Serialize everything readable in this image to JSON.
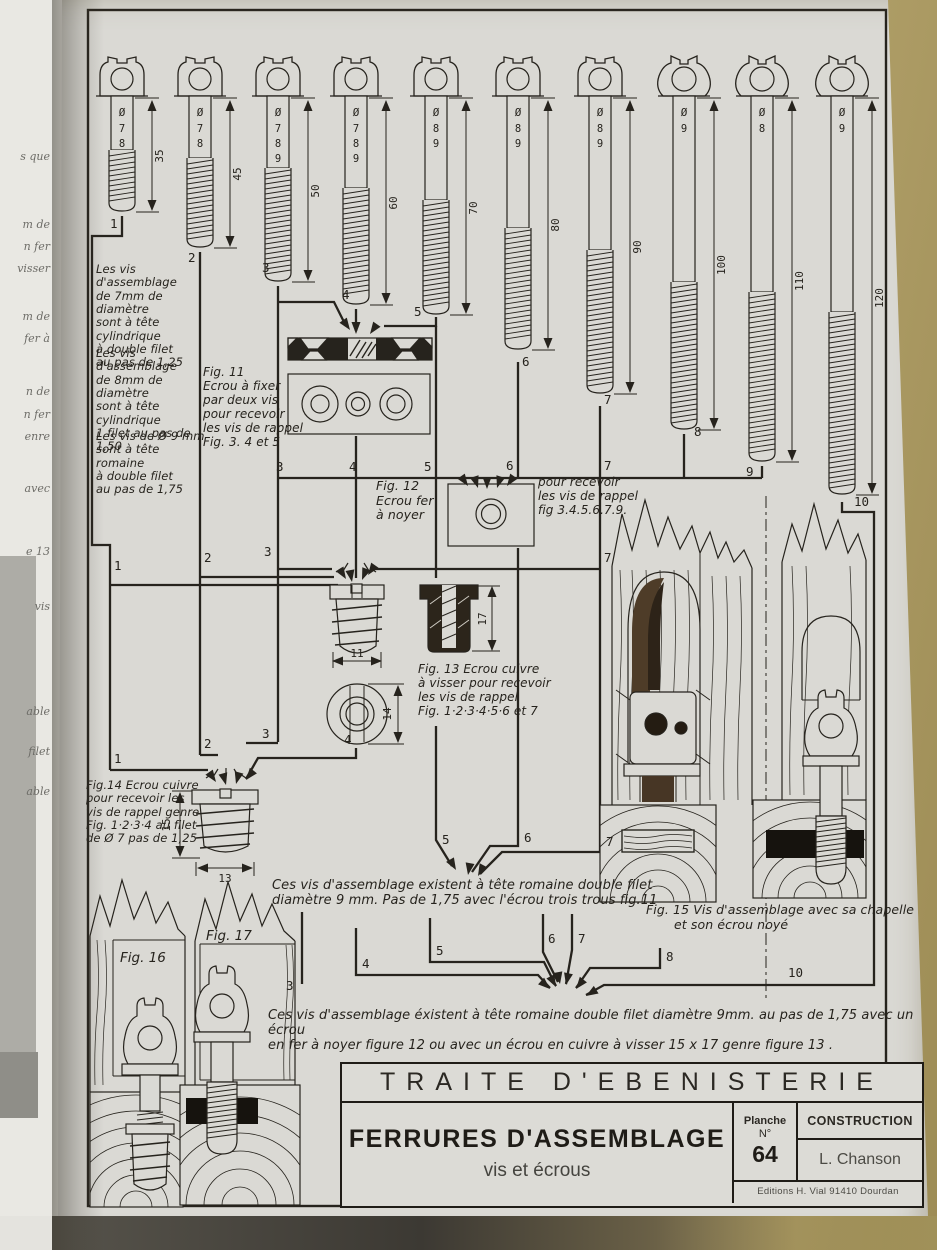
{
  "plate": {
    "screws": [
      {
        "number": "1",
        "diameters": [
          "7",
          "8"
        ],
        "length": "35"
      },
      {
        "number": "2",
        "diameters": [
          "7",
          "8"
        ],
        "length": "45"
      },
      {
        "number": "3",
        "diameters": [
          "7",
          "8",
          "9"
        ],
        "length": "50"
      },
      {
        "number": "4",
        "diameters": [
          "7",
          "8",
          "9"
        ],
        "length": "60"
      },
      {
        "number": "5",
        "diameters": [
          "8",
          "9"
        ],
        "length": "70"
      },
      {
        "number": "6",
        "diameters": [
          "8",
          "9"
        ],
        "length": "80"
      },
      {
        "number": "7",
        "diameters": [
          "8",
          "9"
        ],
        "length": "90"
      },
      {
        "number": "8",
        "diameters": [
          "9"
        ],
        "length": "100"
      },
      {
        "number": "9",
        "diameters": [
          "8"
        ],
        "length": "110"
      },
      {
        "number": "10",
        "diameters": [
          "9"
        ],
        "length": "120"
      }
    ],
    "screw_notes": [
      {
        "lines": [
          "Les vis d'assemblage",
          "de 7mm de diamètre",
          "sont à tête cylindrique",
          "à double filet",
          "au pas de 1,25"
        ]
      },
      {
        "lines": [
          "Les vis d'assemblage",
          "de 8mm de diamètre",
          "sont à tête cylindrique",
          "1 filet au pas de 1,50"
        ]
      },
      {
        "lines": [
          "Les vis de Ø 9 mm",
          "sont à tête romaine",
          "à double filet",
          "au pas de 1,75"
        ]
      }
    ],
    "figures": {
      "fig11": {
        "caption": [
          "Fig. 11",
          "Ecrou à fixer",
          "par deux vis",
          "pour recevoir",
          "les vis de rappel",
          "Fig. 3. 4 et 5"
        ]
      },
      "fig12": {
        "caption": [
          "Fig. 12",
          "Ecrou fer",
          "à noyer"
        ],
        "note": [
          "pour recevoir",
          "les vis de rappel",
          "fig 3.4.5.6.7.9."
        ]
      },
      "fig13": {
        "caption": [
          "Fig. 13  Ecrou cuivre",
          "à visser pour recevoir",
          "les vis de rappel",
          "Fig. 1·2·3·4·5·6 et 7"
        ],
        "dims": {
          "width": "11",
          "height": "17",
          "diameter": "14"
        }
      },
      "fig14": {
        "caption": [
          "Fig.14  Ecrou cuivre",
          "pour recevoir les",
          "vis de rappel genre",
          "Fig. 1·2·3·4  au filet",
          "de Ø 7  pas de 1,25"
        ],
        "dims": {
          "height": "15",
          "width": "13"
        }
      },
      "fig15": {
        "caption": [
          "Fig. 15  Vis d'assemblage avec sa chapelle",
          "et son écrou noyé"
        ]
      },
      "fig16": {
        "label": "Fig. 16"
      },
      "fig17": {
        "label": "Fig. 17"
      }
    },
    "route_labels": {
      "bus_a": [
        "3",
        "4",
        "5",
        "6",
        "7"
      ],
      "bus_b": [
        "1",
        "2",
        "3",
        "7"
      ],
      "bus_c": [
        "1",
        "2",
        "3",
        "4"
      ],
      "mid": [
        "5",
        "6",
        "7"
      ],
      "bus_e": [
        "4",
        "5",
        "6",
        "7",
        "8",
        "10"
      ],
      "stub": [
        "3"
      ]
    },
    "notes": {
      "mid": [
        "Ces vis d'assemblage existent à tête romaine double filet",
        "diamètre  9 mm.  Pas de 1,75 avec l'écrou trois trous fig.11"
      ],
      "bottom": [
        "Ces vis d'assemblage éxistent à tête romaine double filet diamètre 9mm. au pas de 1,75 avec un écrou",
        "en fer à noyer figure 12 ou avec un écrou en cuivre à visser 15 x 17 genre figure 13 ."
      ]
    }
  },
  "title_block": {
    "treatise": "TRAITE  D'EBENISTERIE",
    "title": "FERRURES D'ASSEMBLAGE",
    "subtitle": "vis et écrous",
    "planche_label": "Planche",
    "numero_label": "N°",
    "planche_number": "64",
    "category": "CONSTRUCTION",
    "author": "L. Chanson",
    "publisher": "Editions H. Vial  91410 Dourdan"
  },
  "margin_fragments": [
    "s que",
    "m de",
    "n fer",
    "visser",
    "m de",
    "fer à",
    "n de",
    "n fer",
    "enre",
    "avec",
    "e 13",
    "vis",
    "able",
    "filet",
    "able"
  ],
  "colors": {
    "paper": "#dad9d4",
    "ink": "#26231d",
    "table": "#b2a169",
    "wood_shadow": "#4a3929",
    "facing_page": "#e9e8e3"
  }
}
